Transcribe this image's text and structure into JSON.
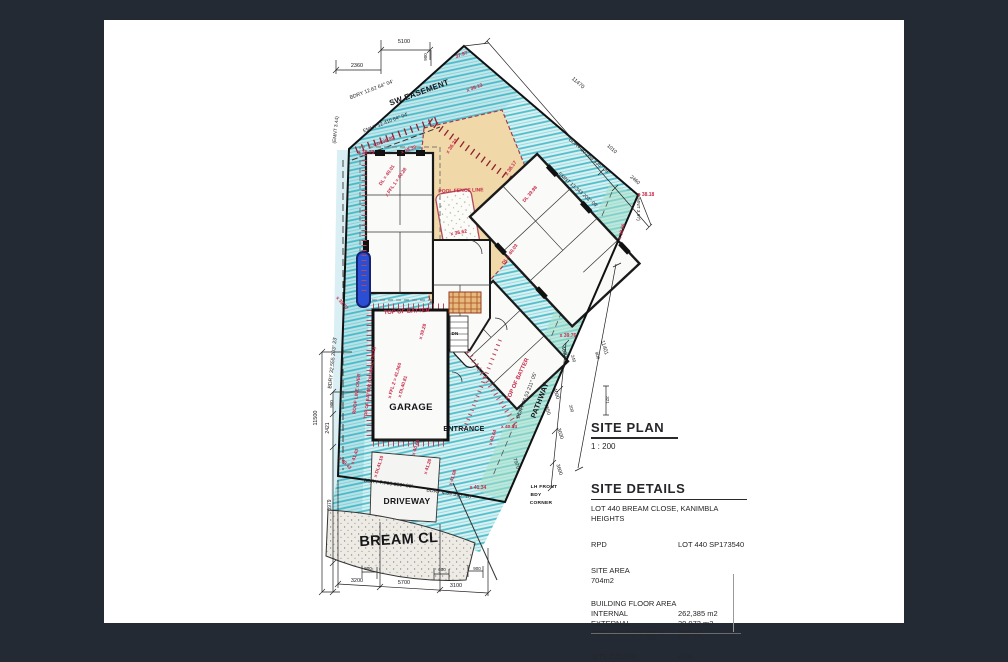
{
  "colors": {
    "background": "#232a33",
    "paper": "#ffffff",
    "hatch_teal": "#4fc3cf",
    "deck_tan": "#f0d8a8",
    "annotation_red": "#c62a4a",
    "ink": "#1c1c1c",
    "water_blue": "#2a4fd4"
  },
  "plan": {
    "annotations": [
      {
        "t": "SW EASEMENT",
        "k": "label"
      },
      {
        "t": "GARAGE",
        "k": "label"
      },
      {
        "t": "ENTRANCE",
        "k": "label"
      },
      {
        "t": "DRIVEWAY",
        "k": "label"
      },
      {
        "t": "BREAM CL",
        "k": "label"
      },
      {
        "t": "PATHWAY",
        "k": "label"
      },
      {
        "t": "DN",
        "k": "label"
      },
      {
        "t": "LH FRONT",
        "k": "label"
      },
      {
        "t": "BDY",
        "k": "label"
      },
      {
        "t": "CORNER",
        "k": "label"
      },
      {
        "t": "BDRY 12.62 64° 04'",
        "k": "bdry"
      },
      {
        "t": "EMNT 12.410 64° 04'",
        "k": "bdry"
      },
      {
        "t": "BDRY 20.059 335° 09'",
        "k": "bdry"
      },
      {
        "t": "EMNT 13.343 203° 09'",
        "k": "bdry"
      },
      {
        "t": "(EMNT 3.97)",
        "k": "bdry"
      },
      {
        "t": "(EMNT 3.44)",
        "k": "bdry"
      },
      {
        "t": "BDRY 32.555 203° 23'",
        "k": "bdry"
      },
      {
        "t": "BDRY 7.709 280° 08'",
        "k": "bdry"
      },
      {
        "t": "BDRY 4.59 310° 18'",
        "k": "bdry"
      },
      {
        "t": "BDRY 36.53 211° 05'",
        "k": "bdry"
      },
      {
        "t": "5100",
        "k": "dim"
      },
      {
        "t": "900",
        "k": "dim"
      },
      {
        "t": "2360",
        "k": "dim"
      },
      {
        "t": "11470",
        "k": "dim"
      },
      {
        "t": "1010",
        "k": "dim"
      },
      {
        "t": "2460",
        "k": "dim"
      },
      {
        "t": "11401",
        "k": "dim"
      },
      {
        "t": "4600",
        "k": "dim"
      },
      {
        "t": "900",
        "k": "dim"
      },
      {
        "t": "240",
        "k": "dim"
      },
      {
        "t": "4600",
        "k": "dim"
      },
      {
        "t": "7550",
        "k": "dim"
      },
      {
        "t": "200",
        "k": "dim"
      },
      {
        "t": "321",
        "k": "dim"
      },
      {
        "t": "3030",
        "k": "dim"
      },
      {
        "t": "3600",
        "k": "dim"
      },
      {
        "t": "7970",
        "k": "dim"
      },
      {
        "t": "11500",
        "k": "dim"
      },
      {
        "t": "900",
        "k": "dim"
      },
      {
        "t": "2421",
        "k": "dim"
      },
      {
        "t": "3979",
        "k": "dim"
      },
      {
        "t": "3200",
        "k": "dim"
      },
      {
        "t": "5700",
        "k": "dim"
      },
      {
        "t": "3100",
        "k": "dim"
      },
      {
        "t": "900",
        "k": "dim"
      },
      {
        "t": "600",
        "k": "dim"
      },
      {
        "t": "900",
        "k": "dim"
      },
      {
        "t": "x 38.73",
        "k": "level"
      },
      {
        "t": "37.97",
        "k": "level"
      },
      {
        "t": "x 38.13",
        "k": "level"
      },
      {
        "t": "x DL38.99",
        "k": "level"
      },
      {
        "t": "x 38.39",
        "k": "level"
      },
      {
        "t": "x 36.23",
        "k": "level"
      },
      {
        "t": "x 38.17",
        "k": "level"
      },
      {
        "t": "x 36.62",
        "k": "level"
      },
      {
        "t": "DL 39.98",
        "k": "level"
      },
      {
        "t": "x 38.18",
        "k": "level"
      },
      {
        "t": "x 38.56",
        "k": "level"
      },
      {
        "t": "x 39.76",
        "k": "level"
      },
      {
        "t": "POOL FENCE LINE",
        "k": "level"
      },
      {
        "t": "TOP OF BATTER",
        "k": "level"
      },
      {
        "t": "TOP OF BATTER",
        "k": "level"
      },
      {
        "t": "ROOF LINE OVER",
        "k": "level"
      },
      {
        "t": "TOP OF BATTER (ON WALL FACE)",
        "k": "level"
      },
      {
        "t": "DL = 40.01",
        "k": "level"
      },
      {
        "t": "x FFL 1 = 40.28",
        "k": "level"
      },
      {
        "t": "x 39.28",
        "k": "level"
      },
      {
        "t": "x FFL 2 = 41.060",
        "k": "level"
      },
      {
        "t": "x DL40.81",
        "k": "level"
      },
      {
        "t": "DL = 40.03",
        "k": "level"
      },
      {
        "t": "x 39.77",
        "k": "level"
      },
      {
        "t": "x 40.43",
        "k": "level"
      },
      {
        "t": "x 41.43",
        "k": "level"
      },
      {
        "t": "x DL41.10",
        "k": "level"
      },
      {
        "t": "x 40.66",
        "k": "level"
      },
      {
        "t": "x 41.26",
        "k": "level"
      },
      {
        "t": "x 41.08",
        "k": "level"
      },
      {
        "t": "x 41.34",
        "k": "level"
      },
      {
        "t": "x 40.84",
        "k": "level"
      },
      {
        "t": "x 40.64",
        "k": "level"
      }
    ]
  },
  "title_block": {
    "title": "SITE PLAN",
    "scale": "1 : 200",
    "details_heading": "SITE DETAILS",
    "address": "LOT 440 BREAM CLOSE, KANIMBLA",
    "address2": "HEIGHTS",
    "rpd_label": "RPD",
    "rpd_value": "LOT 440 SP173540",
    "site_area_label": "SITE AREA",
    "site_area_value": "704m2",
    "bfa_heading": "BUILDING FLOOR AREA",
    "bfa_rows": [
      {
        "label": "INTERNAL",
        "value": "262,385 m2"
      },
      {
        "label": "EXTERNAL",
        "value": "30.072 m2"
      },
      {
        "label": "TOTAL FLOOR AREA",
        "value": "298 m2"
      }
    ],
    "site_cover_label": "SITE COVER",
    "site_cover_value": "42%"
  }
}
